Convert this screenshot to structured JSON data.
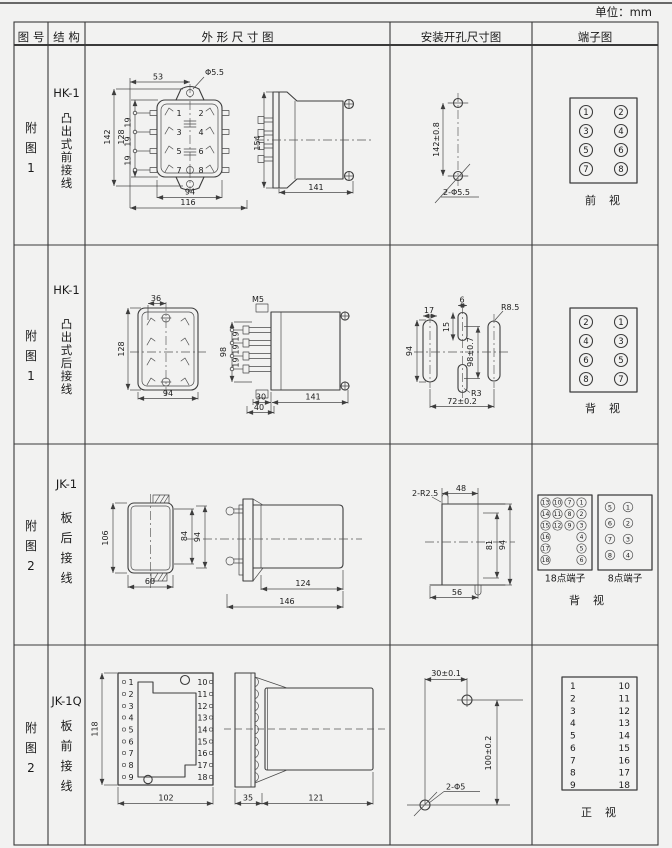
{
  "page": {
    "unit_label": "单位：mm"
  },
  "header": {
    "col_fig": "图 号",
    "col_structure": "结 构",
    "col_outline": "外 形 尺 寸 图",
    "col_mounting": "安装开孔尺寸图",
    "col_terminal": "端子图"
  },
  "rows": [
    {
      "fig": "附\n图\n1",
      "model": "HK-1",
      "structure": "凸\n出\n式\n前\n接\n线",
      "outline": {
        "d53": "53",
        "phi": "Φ5.5",
        "d142": "142",
        "d128": "128",
        "d19_1": "19",
        "d19_2": "19",
        "d19_3": "19",
        "d94": "94",
        "d116": "116",
        "d154": "154",
        "d141": "141",
        "t1": "1",
        "t2": "2",
        "t3": "3",
        "t4": "4",
        "t5": "5",
        "t6": "6",
        "t7": "7",
        "t8": "8"
      },
      "mounting": {
        "dv": "142±0.8",
        "holes": "2-Φ5.5"
      },
      "terminal": {
        "n": [
          "1",
          "2",
          "3",
          "4",
          "5",
          "6",
          "7",
          "8"
        ],
        "caption": "前　视"
      }
    },
    {
      "fig": "附\n图\n1",
      "model": "HK-1",
      "structure": "凸\n出\n式\n后\n接\n线",
      "outline": {
        "d36": "36",
        "d128": "128",
        "d94": "94",
        "m5": "M5",
        "d98": "98",
        "d19_1": "19",
        "d19_2": "19",
        "d19_3": "19",
        "d30": "30",
        "d40": "40",
        "d141": "141"
      },
      "mounting": {
        "d17": "17",
        "d6": "6",
        "d15": "15",
        "d94": "94",
        "d98": "98±0.7",
        "r85": "R8.5",
        "r3": "R3",
        "d72": "72±0.2"
      },
      "terminal": {
        "n": [
          "2",
          "1",
          "4",
          "3",
          "6",
          "5",
          "8",
          "7"
        ],
        "caption": "背　视"
      }
    },
    {
      "fig": "附\n图\n2",
      "model": "JK-1",
      "structure": "板\n后\n接\n线",
      "outline": {
        "d106": "106",
        "d84": "84",
        "d94": "94",
        "d60": "60",
        "d124": "124",
        "d146": "146"
      },
      "mounting": {
        "r25": "2-R2.5",
        "d48": "48",
        "d81": "81",
        "d94": "94",
        "d56": "56"
      },
      "terminal18": {
        "label": "18点端子",
        "n": [
          "13",
          "10",
          "7",
          "1",
          "14",
          "11",
          "8",
          "2",
          "15",
          "12",
          "9",
          "3",
          "16",
          "4",
          "17",
          "5",
          "18",
          "6"
        ]
      },
      "terminal8": {
        "label": "8点端子",
        "n": [
          "5",
          "1",
          "6",
          "2",
          "7",
          "3",
          "8",
          "4"
        ]
      },
      "caption": "背　视"
    },
    {
      "fig": "附\n图\n2",
      "model": "JK-1Q",
      "structure": "板\n前\n接\n线",
      "outline": {
        "d118": "118",
        "d102": "102",
        "d35": "35",
        "d121": "121",
        "left": [
          "1",
          "2",
          "3",
          "4",
          "5",
          "6",
          "7",
          "8",
          "9"
        ],
        "right": [
          "10",
          "11",
          "12",
          "13",
          "14",
          "15",
          "16",
          "17",
          "18"
        ]
      },
      "mounting": {
        "dh": "30±0.1",
        "dv": "100±0.2",
        "holes": "2-Φ5"
      },
      "terminal": {
        "left": [
          "1",
          "2",
          "3",
          "4",
          "5",
          "6",
          "7",
          "8",
          "9"
        ],
        "right": [
          "10",
          "11",
          "12",
          "13",
          "14",
          "15",
          "16",
          "17",
          "18"
        ],
        "caption": "正　视"
      }
    }
  ]
}
